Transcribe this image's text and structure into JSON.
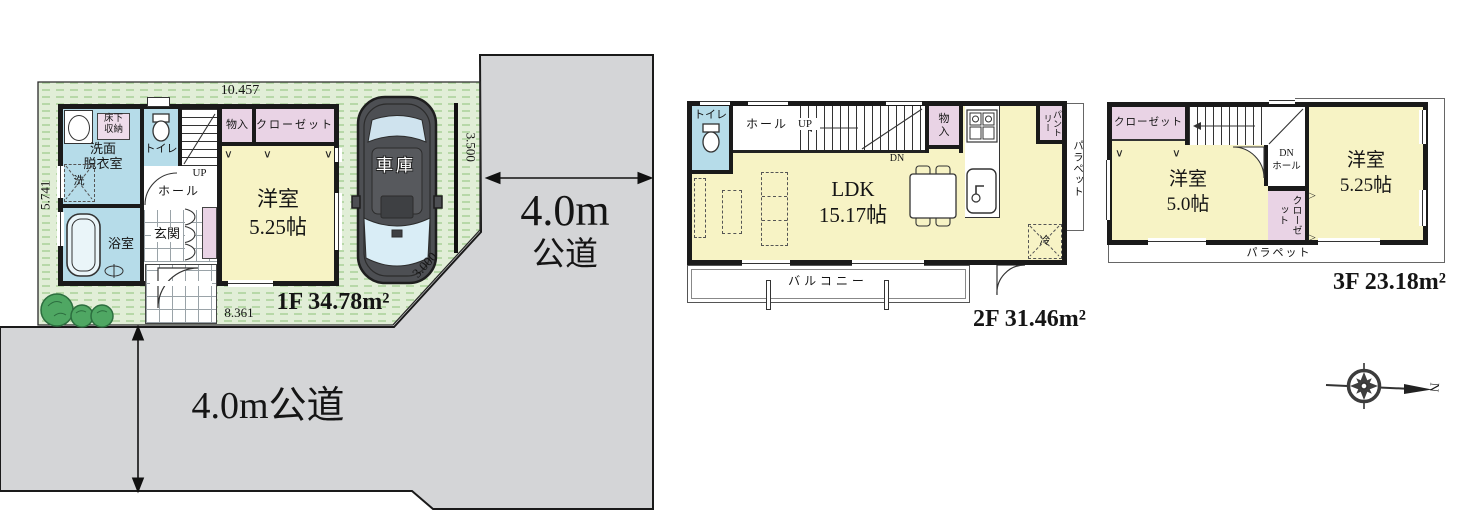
{
  "roads": {
    "right_size": "4.0m",
    "right_type": "公道",
    "bottom": "4.0m公道"
  },
  "site": {
    "dim_top": "10.457",
    "dim_left": "5.741",
    "dim_bottom": "8.361",
    "dim_right": "3.500",
    "dim_corner": "3.000"
  },
  "compass": {
    "north": "N"
  },
  "f1": {
    "area": "1F 34.78m²",
    "rooms": {
      "underfloor": "床下\n収納",
      "washroom": "洗面\n脱衣室",
      "laundry": "洗",
      "bath": "浴室",
      "toilet": "トイレ",
      "up": "UP",
      "hall": "ホール",
      "entrance": "玄関",
      "storage": "物入",
      "closet": "クローゼット",
      "bedroom": "洋室\n5.25帖",
      "garage": "車庫"
    }
  },
  "f2": {
    "area": "2F 31.46m²",
    "rooms": {
      "toilet": "トイレ",
      "hall": "ホール",
      "up": "UP",
      "dn": "DN",
      "storage": "物\n入",
      "pantry": "パントリー",
      "parapet": "パラペット",
      "ldk": "LDK\n15.17帖",
      "fridge": "冷",
      "balcony": "バルコニー"
    }
  },
  "f3": {
    "area": "3F 23.18m²",
    "rooms": {
      "closet": "クローゼット",
      "dn": "DN",
      "hall": "ホール",
      "room1": "洋室\n5.0帖",
      "closet2": "クローゼット",
      "room2": "洋室\n5.25帖",
      "parapet": "パラペット"
    }
  },
  "colors": {
    "site_green": "#e1eed7",
    "hatch_green": "#b7d8a8",
    "road_gray": "#d4d5d7",
    "room_blue": "#b6dce9",
    "room_yellow": "#f7f3c5",
    "room_pink": "#e9d3e5",
    "wall_black": "#1a1a1a"
  }
}
